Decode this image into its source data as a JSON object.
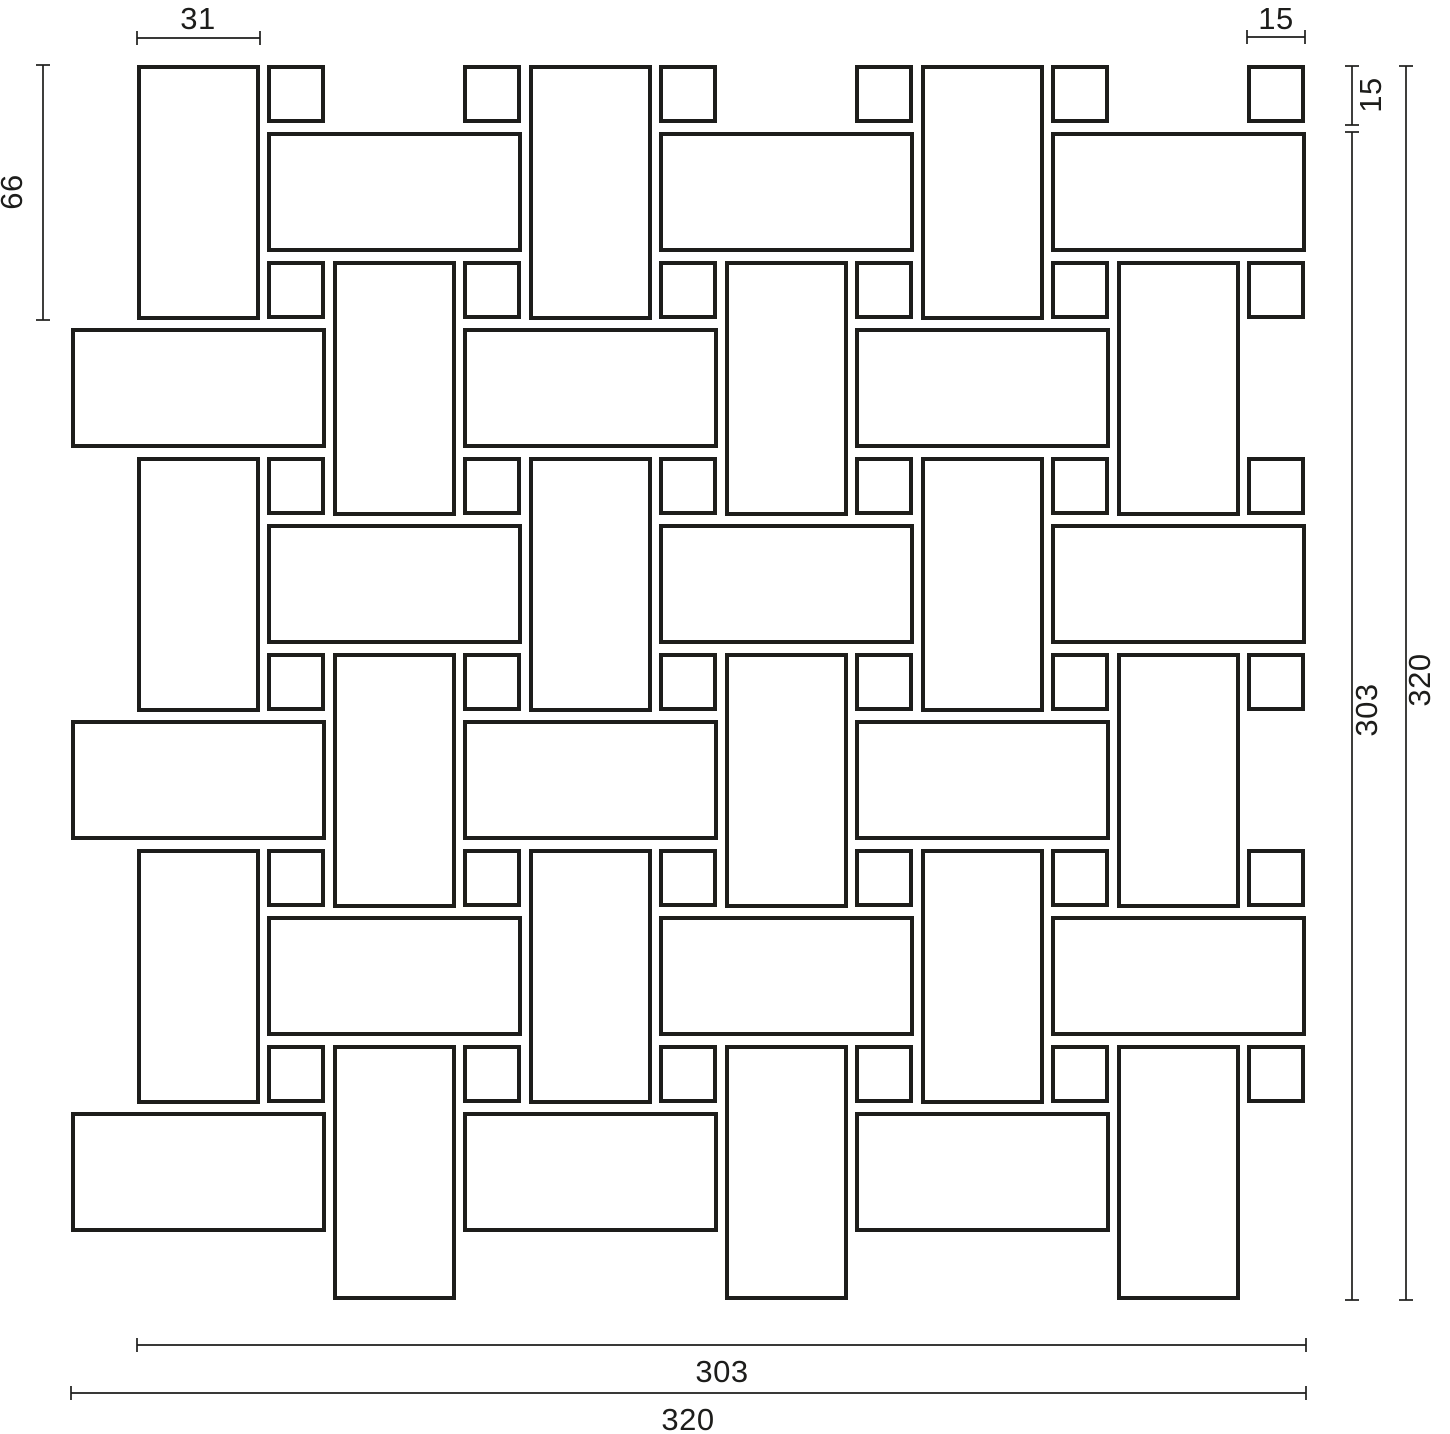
{
  "drawing": {
    "title": "Basketweave mosaic sheet dimension drawing",
    "background_color": "#ffffff",
    "line_color": "#1d1d1b",
    "tile_fill_color": "#ffffff",
    "labels": {
      "tile_width_top_left": "31",
      "dot_size_top_right": "15",
      "tile_length_left": "66",
      "dot_offset_right": "15",
      "module_right": "303",
      "sheet_right": "320",
      "module_bottom": "303",
      "sheet_bottom": "320"
    },
    "product_dimensions": {
      "rectangle_tile": {
        "width": 31,
        "length": 66
      },
      "dot_tile": {
        "width": 15,
        "height": 15
      },
      "module_size": 303,
      "sheet_size": 320
    }
  },
  "pattern": {
    "origin_x": 137,
    "origin_y": 65,
    "half_period": 196,
    "vertical_tile": {
      "w": 123,
      "h": 255,
      "cols": 6,
      "rows": 3
    },
    "horizontal_tile": {
      "w": 255,
      "h": 120,
      "first_row_y": 132,
      "even_row_x": 267,
      "odd_row_x": 71,
      "rows": 6,
      "per_row": 3
    },
    "dot": {
      "size": 58,
      "first_col_x": 267,
      "cols": 6,
      "rows": 6
    },
    "stroke_width": 4
  }
}
